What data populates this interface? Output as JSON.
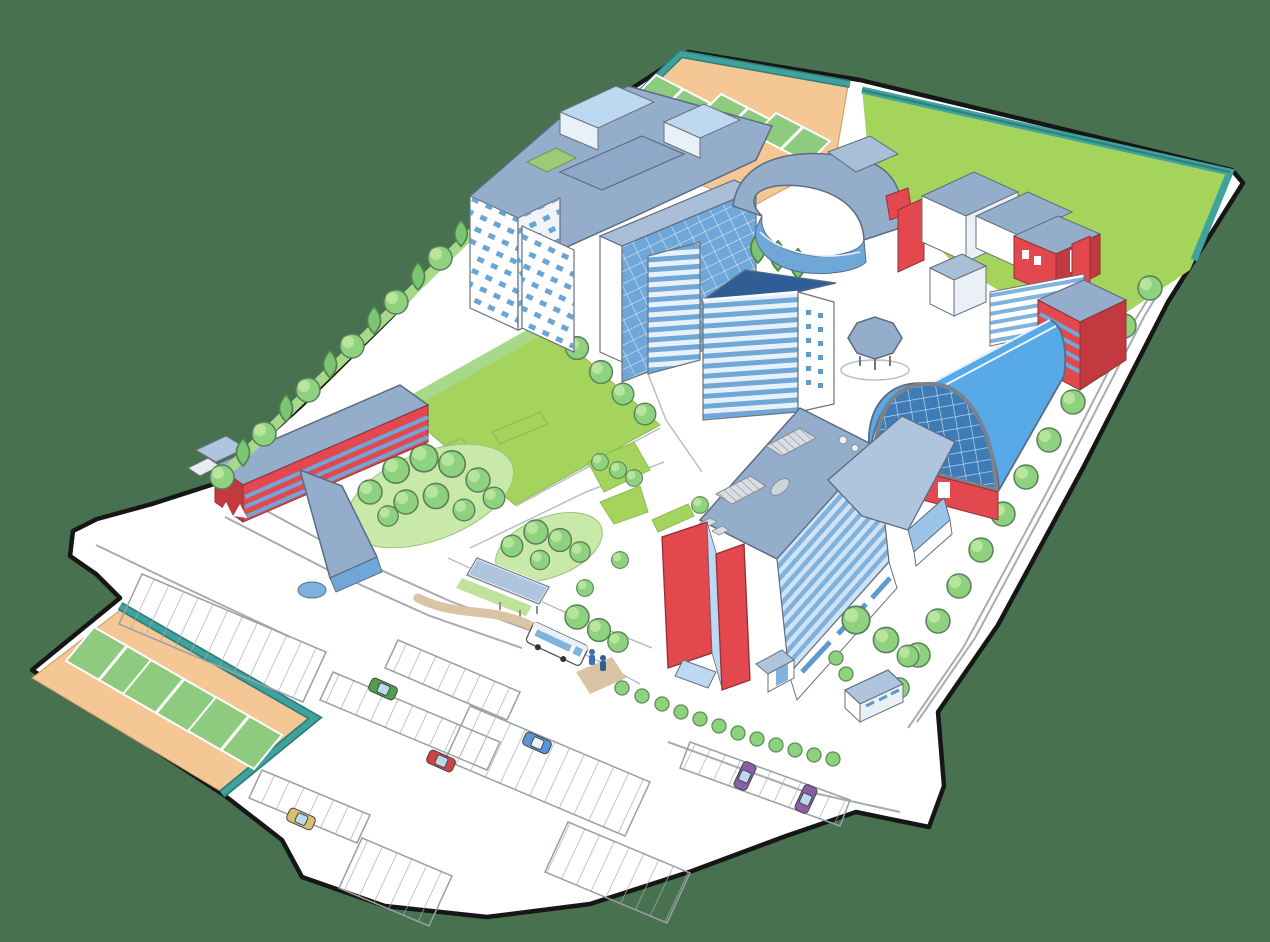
{
  "scene": {
    "name": "illustrated-campus-map",
    "kind": "isometric hand-drawn campus illustration",
    "text_labels": []
  },
  "colors": {
    "background": "#47714F",
    "ground": "#FFFFFF",
    "outline": "#161616",
    "path_line": "#A7ACB2",
    "lawn": "#A4D45C",
    "lawn_light": "#C9E9A8",
    "hedge": "#A8D88A",
    "court_surface": "#F5C795",
    "court_green": "#8FCB7F",
    "fence_teal": "#3FA29C",
    "fence_teal_dark": "#2E7F7A",
    "tree": "#8ED17F",
    "tree_dark": "#5B8F54",
    "roof_slate": "#94ADCB",
    "roof_slate_light": "#AFC4DD",
    "wall_white": "#FFFFFF",
    "glass_light": "#BDD9F2",
    "glass_mid": "#6FA8D8",
    "glass_dark": "#3E7CB8",
    "accent_red": "#E2484D",
    "accent_red_dark": "#C23A40",
    "dome_blue": "#57A9E8",
    "beige_path": "#D9C4A3",
    "car_red": "#CC4444",
    "car_blue": "#5596D6",
    "car_green": "#4E9E4E",
    "car_yellow": "#D9C06E",
    "car_purple": "#8B5FA8",
    "bus_white": "#FFFFFF"
  },
  "features": {
    "north_tennis_courts": 3,
    "south_tennis_courts": 3,
    "parked_cars": 6,
    "buses": 1,
    "buildings": [
      "tower-block",
      "crescent-building",
      "cube-cluster",
      "red-east-building",
      "sports-hall-dome",
      "gazebo",
      "glass-tower",
      "west-red-building",
      "main-building",
      "south-annex"
    ]
  }
}
